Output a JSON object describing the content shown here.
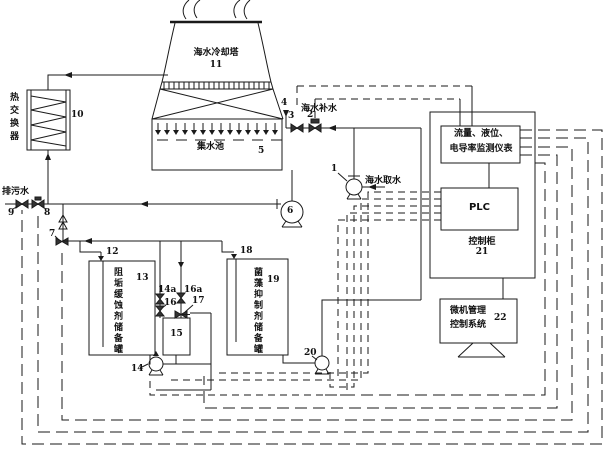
{
  "figure": {
    "type": "process-control-schematic",
    "line_color": "#1a1a1a",
    "labels": {
      "cooling_tower": "海水冷却塔",
      "cooling_tower_num": "11",
      "basin": "集水池",
      "basin_num": "5",
      "heat_exchanger": "热交换器",
      "heat_exchanger_num": "10",
      "blowdown": "排污水",
      "makeup_water": "海水补水",
      "intake_water": "海水取水",
      "inhibitor_tank": "阻垢缓蚀剂储备罐",
      "inhibitor_tank_num": "13",
      "biocide_tank": "菌藻抑制剂储备罐",
      "biocide_tank_num": "19",
      "metering_tank_num": "15",
      "instruments_line1": "流量、液位、",
      "instruments_line2": "电导率监测仪表",
      "plc": "PLC",
      "cabinet": "控制柜",
      "cabinet_num": "21",
      "computer_line1": "微机管理",
      "computer_line2": "控制系统",
      "computer_num": "22",
      "n1": "1",
      "n2": "2",
      "n3": "3",
      "n4": "4",
      "n6": "6",
      "n7": "7",
      "n8": "8",
      "n9": "9",
      "n12": "12",
      "n14": "14",
      "n14a": "14a",
      "n16": "16",
      "n16a": "16a",
      "n17": "17",
      "n18": "18",
      "n20": "20"
    }
  }
}
